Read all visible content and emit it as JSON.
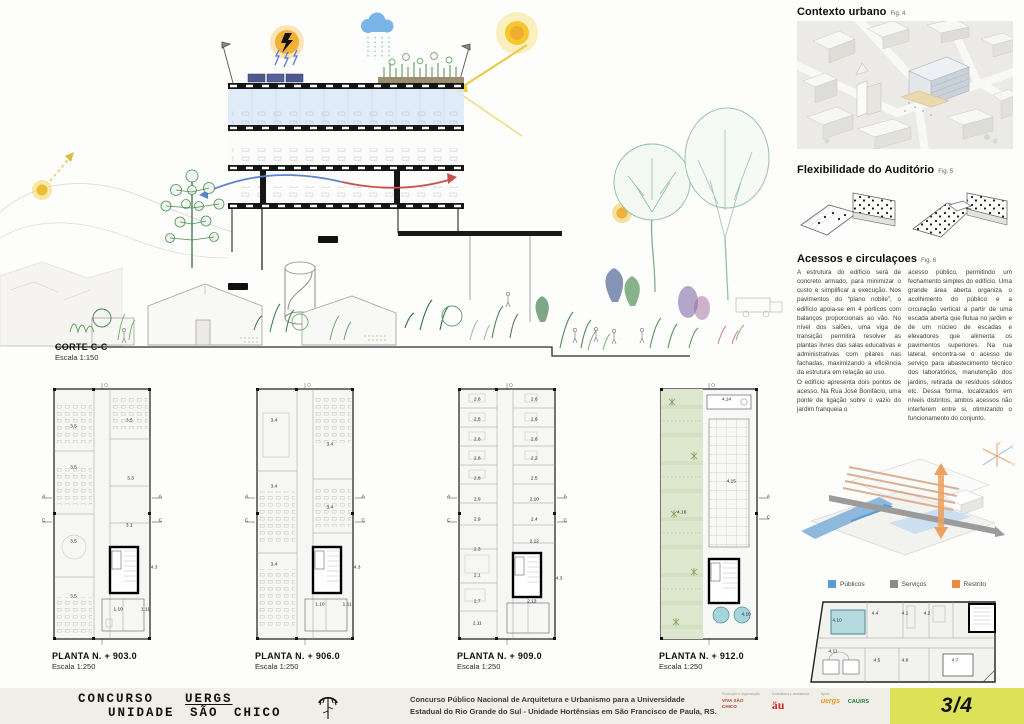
{
  "board": {
    "page_number": "3/4"
  },
  "section": {
    "title": "CORTE C-C",
    "scale": "Escala 1:150"
  },
  "plans": [
    {
      "title": "PLANTA N. + 903.0",
      "scale": "Escala 1:250",
      "rooms": [
        {
          "label": "A",
          "x": 3,
          "y": 44
        },
        {
          "label": "C",
          "x": 3,
          "y": 53
        },
        {
          "label": "A",
          "x": 97,
          "y": 44
        },
        {
          "label": "C",
          "x": 97,
          "y": 53
        },
        {
          "label": "3.5",
          "x": 27,
          "y": 17
        },
        {
          "label": "3.5",
          "x": 72,
          "y": 15
        },
        {
          "label": "3.5",
          "x": 27,
          "y": 33
        },
        {
          "label": "3.3",
          "x": 73,
          "y": 37
        },
        {
          "label": "3.5",
          "x": 27,
          "y": 61
        },
        {
          "label": "3.1",
          "x": 72,
          "y": 55
        },
        {
          "label": "4.3",
          "x": 92,
          "y": 71
        },
        {
          "label": "3.5",
          "x": 27,
          "y": 82
        },
        {
          "label": "1.10",
          "x": 63,
          "y": 87
        },
        {
          "label": "1.11",
          "x": 85,
          "y": 87
        }
      ]
    },
    {
      "title": "PLANTA N. + 906.0",
      "scale": "Escala 1:250",
      "rooms": [
        {
          "label": "A",
          "x": 3,
          "y": 44
        },
        {
          "label": "C",
          "x": 3,
          "y": 53
        },
        {
          "label": "A",
          "x": 97,
          "y": 44
        },
        {
          "label": "C",
          "x": 97,
          "y": 53
        },
        {
          "label": "3.4",
          "x": 25,
          "y": 15
        },
        {
          "label": "3.4",
          "x": 70,
          "y": 24
        },
        {
          "label": "3.4",
          "x": 25,
          "y": 40
        },
        {
          "label": "3.4",
          "x": 70,
          "y": 48
        },
        {
          "label": "3.4",
          "x": 25,
          "y": 70
        },
        {
          "label": "4.3",
          "x": 92,
          "y": 71
        },
        {
          "label": "1.10",
          "x": 62,
          "y": 85
        },
        {
          "label": "1.11",
          "x": 84,
          "y": 85
        }
      ]
    },
    {
      "title": "PLANTA N. + 909.0",
      "scale": "Escala 1:250",
      "rooms": [
        {
          "label": "A",
          "x": 3,
          "y": 44
        },
        {
          "label": "C",
          "x": 3,
          "y": 53
        },
        {
          "label": "A",
          "x": 97,
          "y": 44
        },
        {
          "label": "C",
          "x": 97,
          "y": 53
        },
        {
          "label": "2.8",
          "x": 26,
          "y": 7
        },
        {
          "label": "2.6",
          "x": 72,
          "y": 7
        },
        {
          "label": "2.8",
          "x": 26,
          "y": 14.5
        },
        {
          "label": "2.6",
          "x": 72,
          "y": 14.5
        },
        {
          "label": "2.8",
          "x": 26,
          "y": 22
        },
        {
          "label": "2.6",
          "x": 72,
          "y": 22
        },
        {
          "label": "2.8",
          "x": 26,
          "y": 29.5
        },
        {
          "label": "2.2",
          "x": 72,
          "y": 29.5
        },
        {
          "label": "2.8",
          "x": 26,
          "y": 37
        },
        {
          "label": "2.5",
          "x": 72,
          "y": 37
        },
        {
          "label": "2.9",
          "x": 26,
          "y": 45
        },
        {
          "label": "2.10",
          "x": 72,
          "y": 45
        },
        {
          "label": "2.9",
          "x": 26,
          "y": 52.5
        },
        {
          "label": "2.4",
          "x": 72,
          "y": 52.5
        },
        {
          "label": "2.3",
          "x": 26,
          "y": 64
        },
        {
          "label": "2.12",
          "x": 72,
          "y": 61
        },
        {
          "label": "2.1",
          "x": 26,
          "y": 74
        },
        {
          "label": "4.3",
          "x": 92,
          "y": 75
        },
        {
          "label": "2.7",
          "x": 26,
          "y": 84
        },
        {
          "label": "2.13",
          "x": 70,
          "y": 84
        },
        {
          "label": "2.11",
          "x": 26,
          "y": 92.5
        }
      ]
    },
    {
      "title": "PLANTA N. + 912.0",
      "scale": "Escala 1:250",
      "rooms": [
        {
          "label": "A",
          "x": 98,
          "y": 44
        },
        {
          "label": "C",
          "x": 98,
          "y": 52
        },
        {
          "label": "4.14",
          "x": 64,
          "y": 7
        },
        {
          "label": "4.15",
          "x": 68,
          "y": 38
        },
        {
          "label": "4.16",
          "x": 28,
          "y": 50
        },
        {
          "label": "4.10",
          "x": 80,
          "y": 89
        }
      ]
    }
  ],
  "plan_890": {
    "title": "PLANTA N. + 890.5",
    "scale": "Escala 1:250",
    "rooms": [
      {
        "label": "4.10",
        "x": 17,
        "y": 28
      },
      {
        "label": "4.4",
        "x": 36,
        "y": 20
      },
      {
        "label": "4.1",
        "x": 51,
        "y": 20
      },
      {
        "label": "4.2",
        "x": 62,
        "y": 20
      },
      {
        "label": "4.11",
        "x": 15,
        "y": 62
      },
      {
        "label": "4.5",
        "x": 37,
        "y": 72
      },
      {
        "label": "4.6",
        "x": 51,
        "y": 72
      },
      {
        "label": "4.7",
        "x": 76,
        "y": 72
      }
    ]
  },
  "right_column": {
    "contexto": {
      "title": "Contexto urbano",
      "fig": "Fig. 4"
    },
    "auditorio": {
      "title": "Flexibilidade do Auditório",
      "fig": "Fig. 5"
    },
    "acessos": {
      "title": "Acessos e circulaçoes",
      "fig": "Fig. 6",
      "col1": "A estrutura do edifício será de concreto armado, para minimizar o custo e simplificar a execução. Nos pavimentos do “plano nobile”, o edifício apoia-se em 4 pórticos com balanços proporcionais ao vão. No nível dos salões, uma viga de transição permitirá resolver as plantas livres das salas educativas e administrativas com pilares nas fachadas, maximizando a eficiência da estrutura em relação ao uso.\nO edifício apresenta dois pontos de acesso. Na Rua José Bonifácio, uma ponte de ligação sobre o vazio do jardim franqueia o",
      "col2": "acesso público, permitindo um fechamento simples do edifício. Uma grande área aberta organiza o acolhimento do público e a circulação vertical a partir de uma escada aberta que flutua no jardim e de um núcleo de escadas e elevadores que alimenta os pavimentos superiores. Na rua lateral, encontra-se o acesso de serviço para abastecimento técnico dos laboratórios, manutenção dos jardins, retirada de resíduos sólidos etc. Dessa forma, localizados em níveis distintos, ambos acessos não interferem entre si, otimizando o funcionamento do conjunto."
    },
    "axes": {
      "x": "x",
      "y": "y",
      "z": "z'"
    },
    "legend": [
      {
        "label": "Públicos",
        "color": "#5b9bd5"
      },
      {
        "label": "Serviços",
        "color": "#8a8a8a"
      },
      {
        "label": "Restrito",
        "color": "#ed8a3f"
      }
    ]
  },
  "footer": {
    "title_word1": "CONCURSO",
    "title_word2": "UERGS",
    "title_line2": "UNIDADE SÃO CHICO",
    "credit_line1": "Concurso Público Nacional de Arquitetura e Urbanismo para a Universidade",
    "credit_line2": "Estadual do Rio Grande do Sul - Unidade Hortênsias em São Francisco de Paula, RS.",
    "logo_groups": [
      {
        "label": "Promoção e organização",
        "logos": [
          "VIVA SÃO CHICO"
        ]
      },
      {
        "label": "Consultoria e assessoria",
        "logos": [
          "äu"
        ]
      },
      {
        "label": "Apoio",
        "logos": [
          "uergs",
          "CAU/RS"
        ]
      }
    ]
  }
}
